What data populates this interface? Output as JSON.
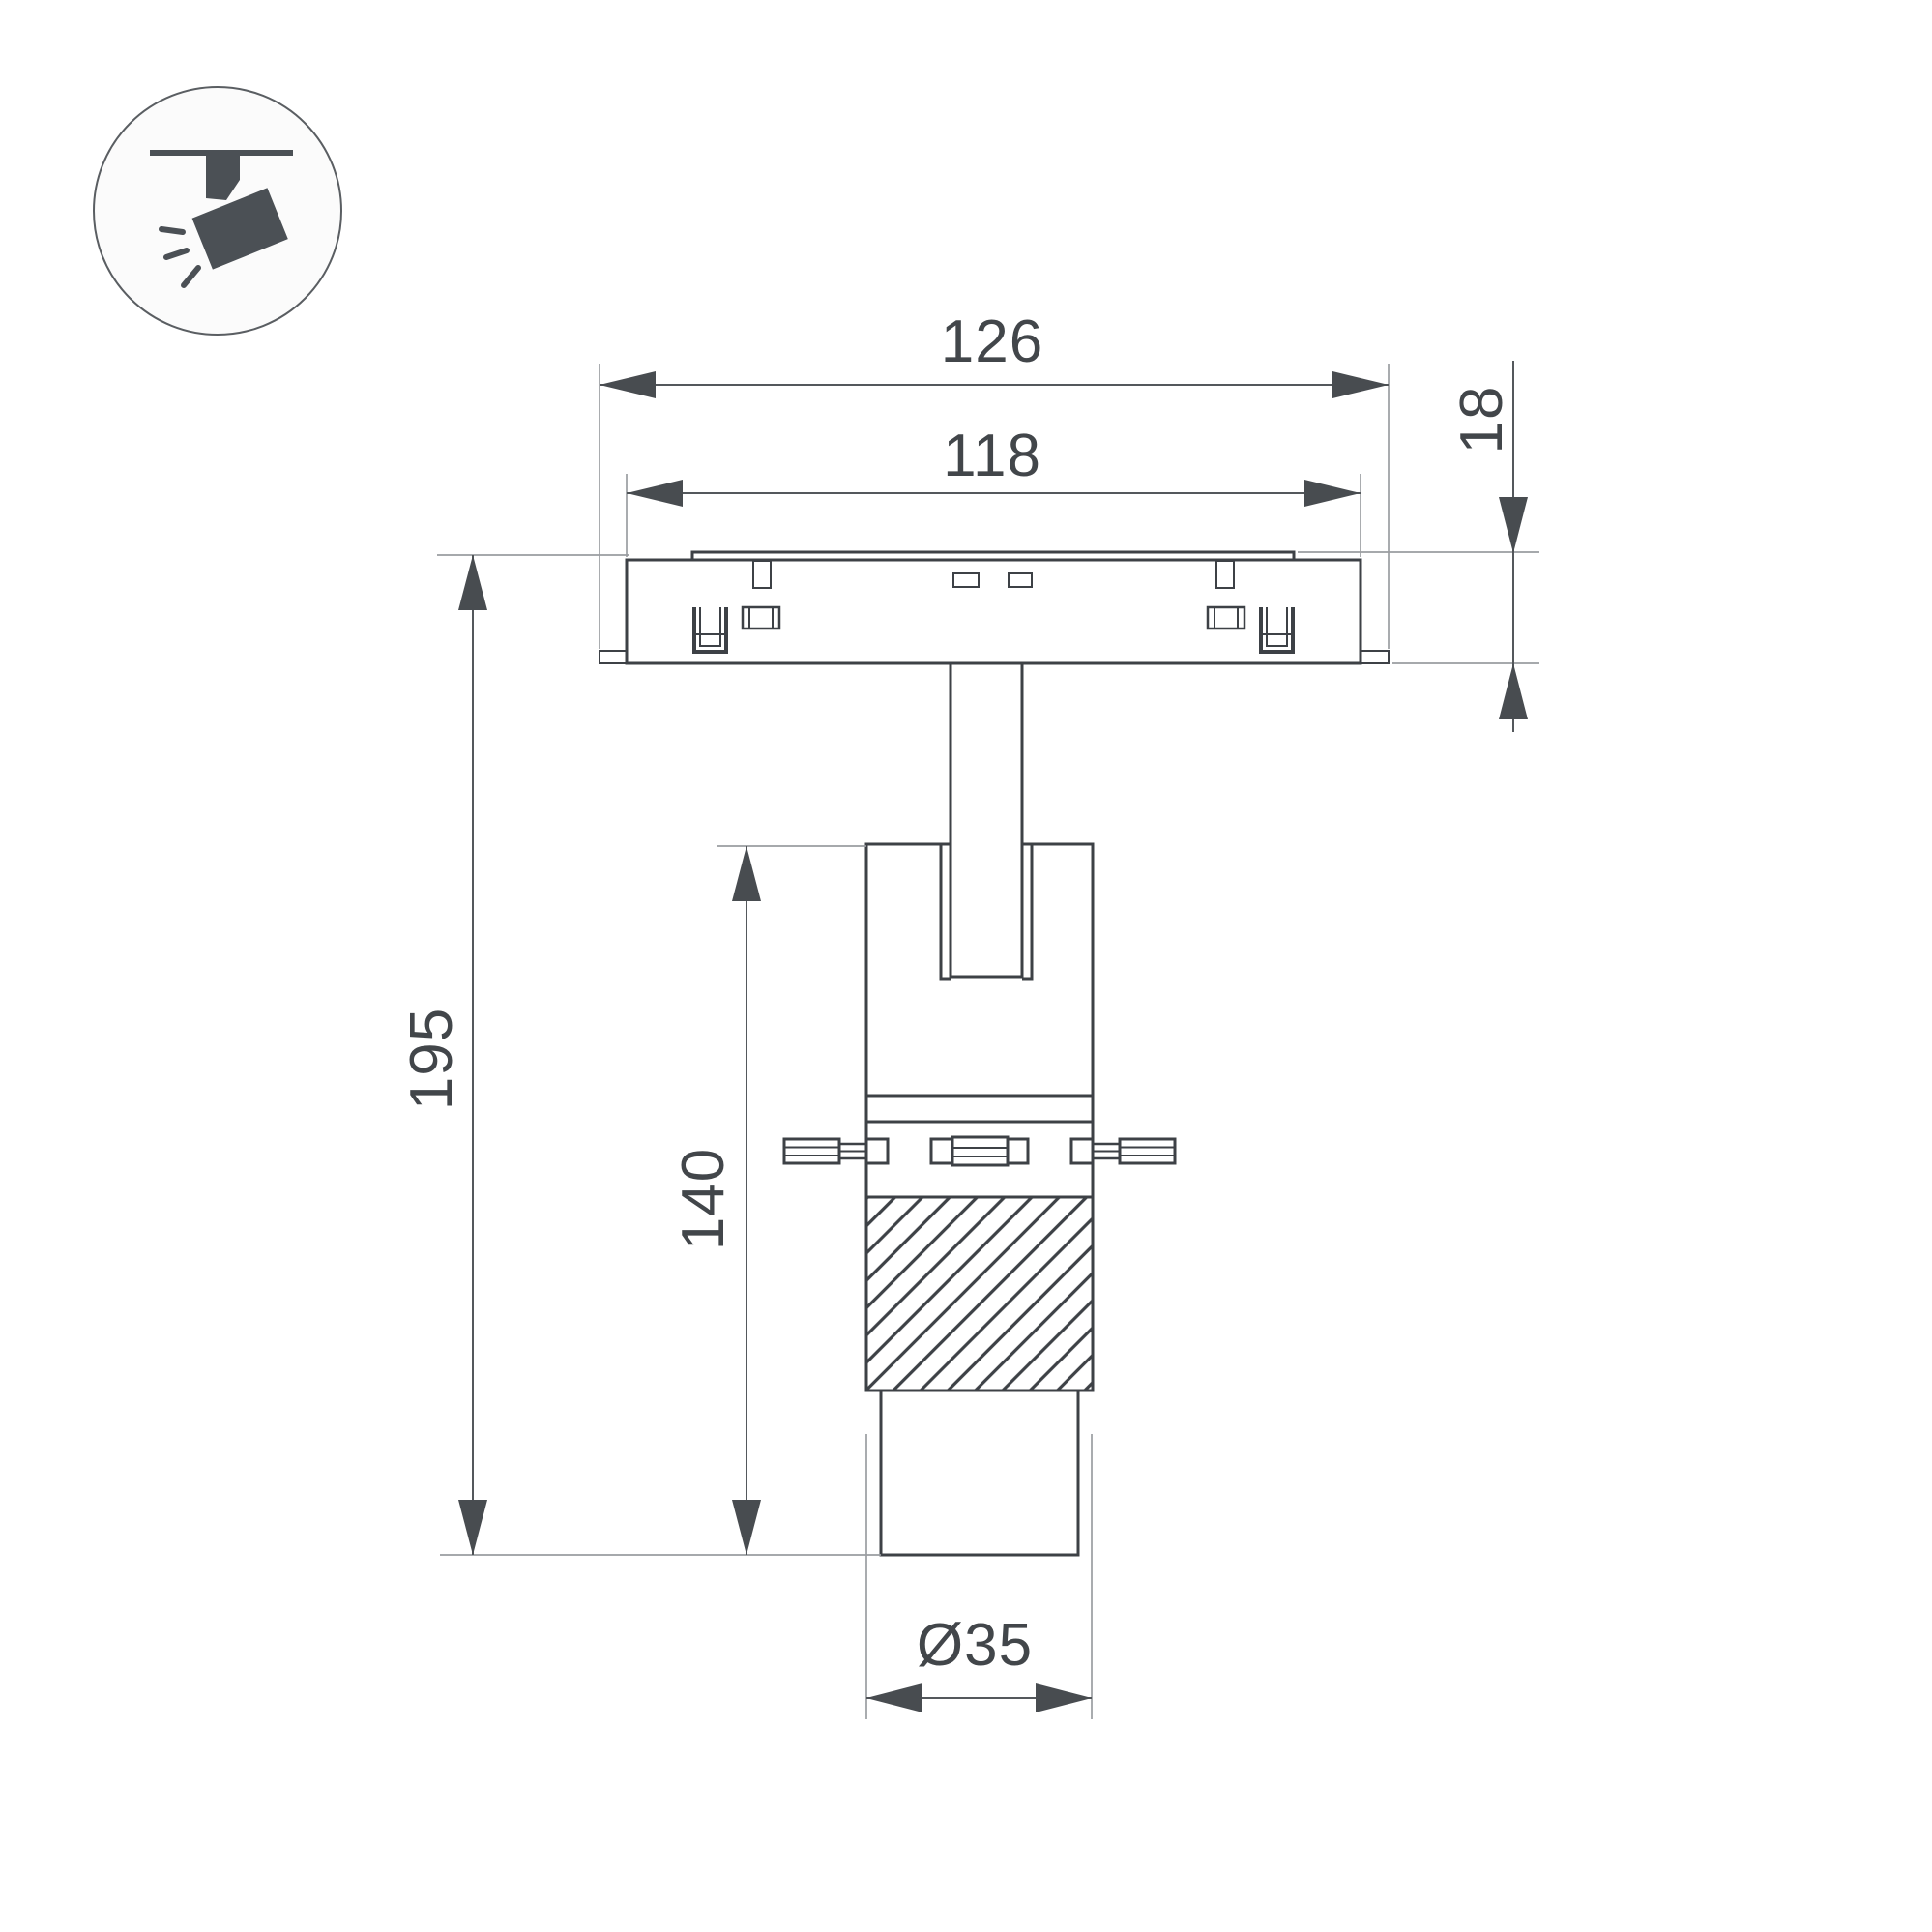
{
  "drawing": {
    "type": "technical-dimension-drawing",
    "subject": "magnetic track spotlight side view"
  },
  "icon": {
    "name": "track-spotlight-icon",
    "parts": [
      "ceiling-line",
      "track-adapter-stem",
      "spotlight-head",
      "light-rays"
    ]
  },
  "dimensions": {
    "track_length": "126",
    "track_inner_length": "118",
    "track_height": "18",
    "total_height": "195",
    "body_height": "140",
    "barrel_diameter": "Ø35"
  },
  "colors": {
    "c-bg": "#ffffff",
    "c-line": "#3d4146",
    "c-thin": "#9a9da1",
    "c-dim": "#54585c",
    "c-arrow": "#484c50",
    "c-text": "#42464a",
    "c-icon": "#4b5055",
    "c-icon-stroke": "#5a5e62"
  }
}
